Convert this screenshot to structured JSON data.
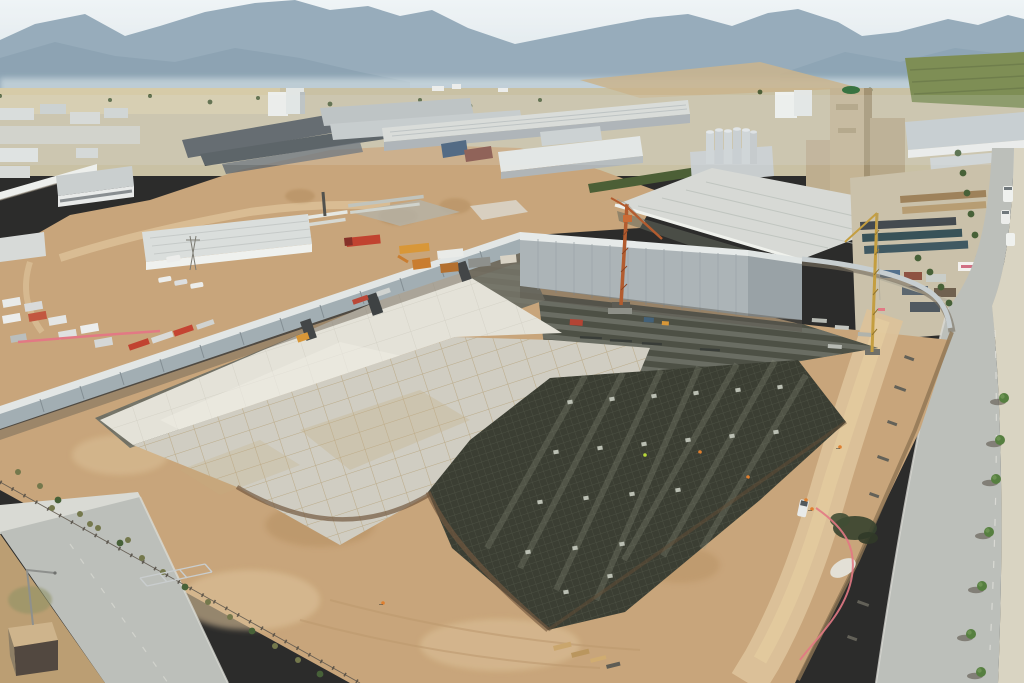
{
  "scene": {
    "setting": "aerial drone photo of an industrial zone with a large building-foundation construction site",
    "sky": "hazy pale sky over blue-gray mountain ranges",
    "background": "valley with tan fields, green orchards and factory warehouses",
    "landmarks": {
      "feed_mill": "tall beige mill tower with green oval logo and silo battery",
      "warehouse": "large light-gray pitched warehouse roof",
      "gray_wall": "tall blank precast concrete wall along site north edge"
    },
    "construction": {
      "slabs": "bright poured concrete slab and formwork-patterned slab",
      "rebar": "dark rebar mat foundation grid with pier caps",
      "lean_concrete": "striped lean-concrete strip along perimeter wall",
      "cranes": [
        "orange tower crane",
        "yellow tower crane"
      ],
      "equipment": [
        "red truck",
        "yellow dump truck",
        "excavators",
        "site office containers"
      ],
      "workers": "tiny hi-vis figures on the rebar and dirt roads",
      "pipes": "pink temporary water pipes"
    },
    "roads": "asphalt road with tree-lined sidewalk on the right, smaller road lower-left with street light and guard booth"
  },
  "colors": {
    "sky_top": "#eef4f7",
    "sky_bottom": "#d5e3ea",
    "mountain": "#93a9ba",
    "mountain_near": "#7f99ac",
    "haze": "#dde8ec",
    "valley": "#c8bfa2",
    "field": "#d6cba6",
    "orchard": "#79894f",
    "tree": "#41522c",
    "scrub": "#8d8f60",
    "roof_light": "#d8dbd7",
    "roof_gray": "#b6bcbe",
    "roof_dark": "#474f55",
    "facade": "#eef0ee",
    "facade_shade": "#a2aaae",
    "blue_bldg": "#2f4d6d",
    "red_bldg": "#7c4236",
    "mill": "#c2b191",
    "mill_shade": "#a08f6e",
    "logo": "#2f6d39",
    "silo": "#ccd2d6",
    "big_roof": "#d6d9d5",
    "wall": "#9fabb1",
    "wall_top": "#e2e6e6",
    "gray_bldg": "#a9b2b6",
    "gray_bldg_side": "#959fa4",
    "dirt": "#c7a276",
    "dirt_light": "#dcc097",
    "dirt_dark": "#a77e50",
    "dirt_orange": "#bf7a42",
    "lean": "#45483e",
    "lean_stripe": "#7d8176",
    "slab_bright": "#e4e2d9",
    "slab_mid": "#cfccc1",
    "form": "#b29c72",
    "rebar": "#32352b",
    "rebar_line": "#565b4a",
    "road": "#babdb9",
    "road_edge": "#d9dad4",
    "sidewalk": "#d9d3c1",
    "crane": "#b05526",
    "crane2": "#c29a38",
    "pink": "#e27380",
    "truck_red": "#bf3a28",
    "truck_yellow": "#d79330",
    "machine": "#e9ebe9",
    "hivis": "#df7a26",
    "hivis_green": "#b6d831"
  }
}
